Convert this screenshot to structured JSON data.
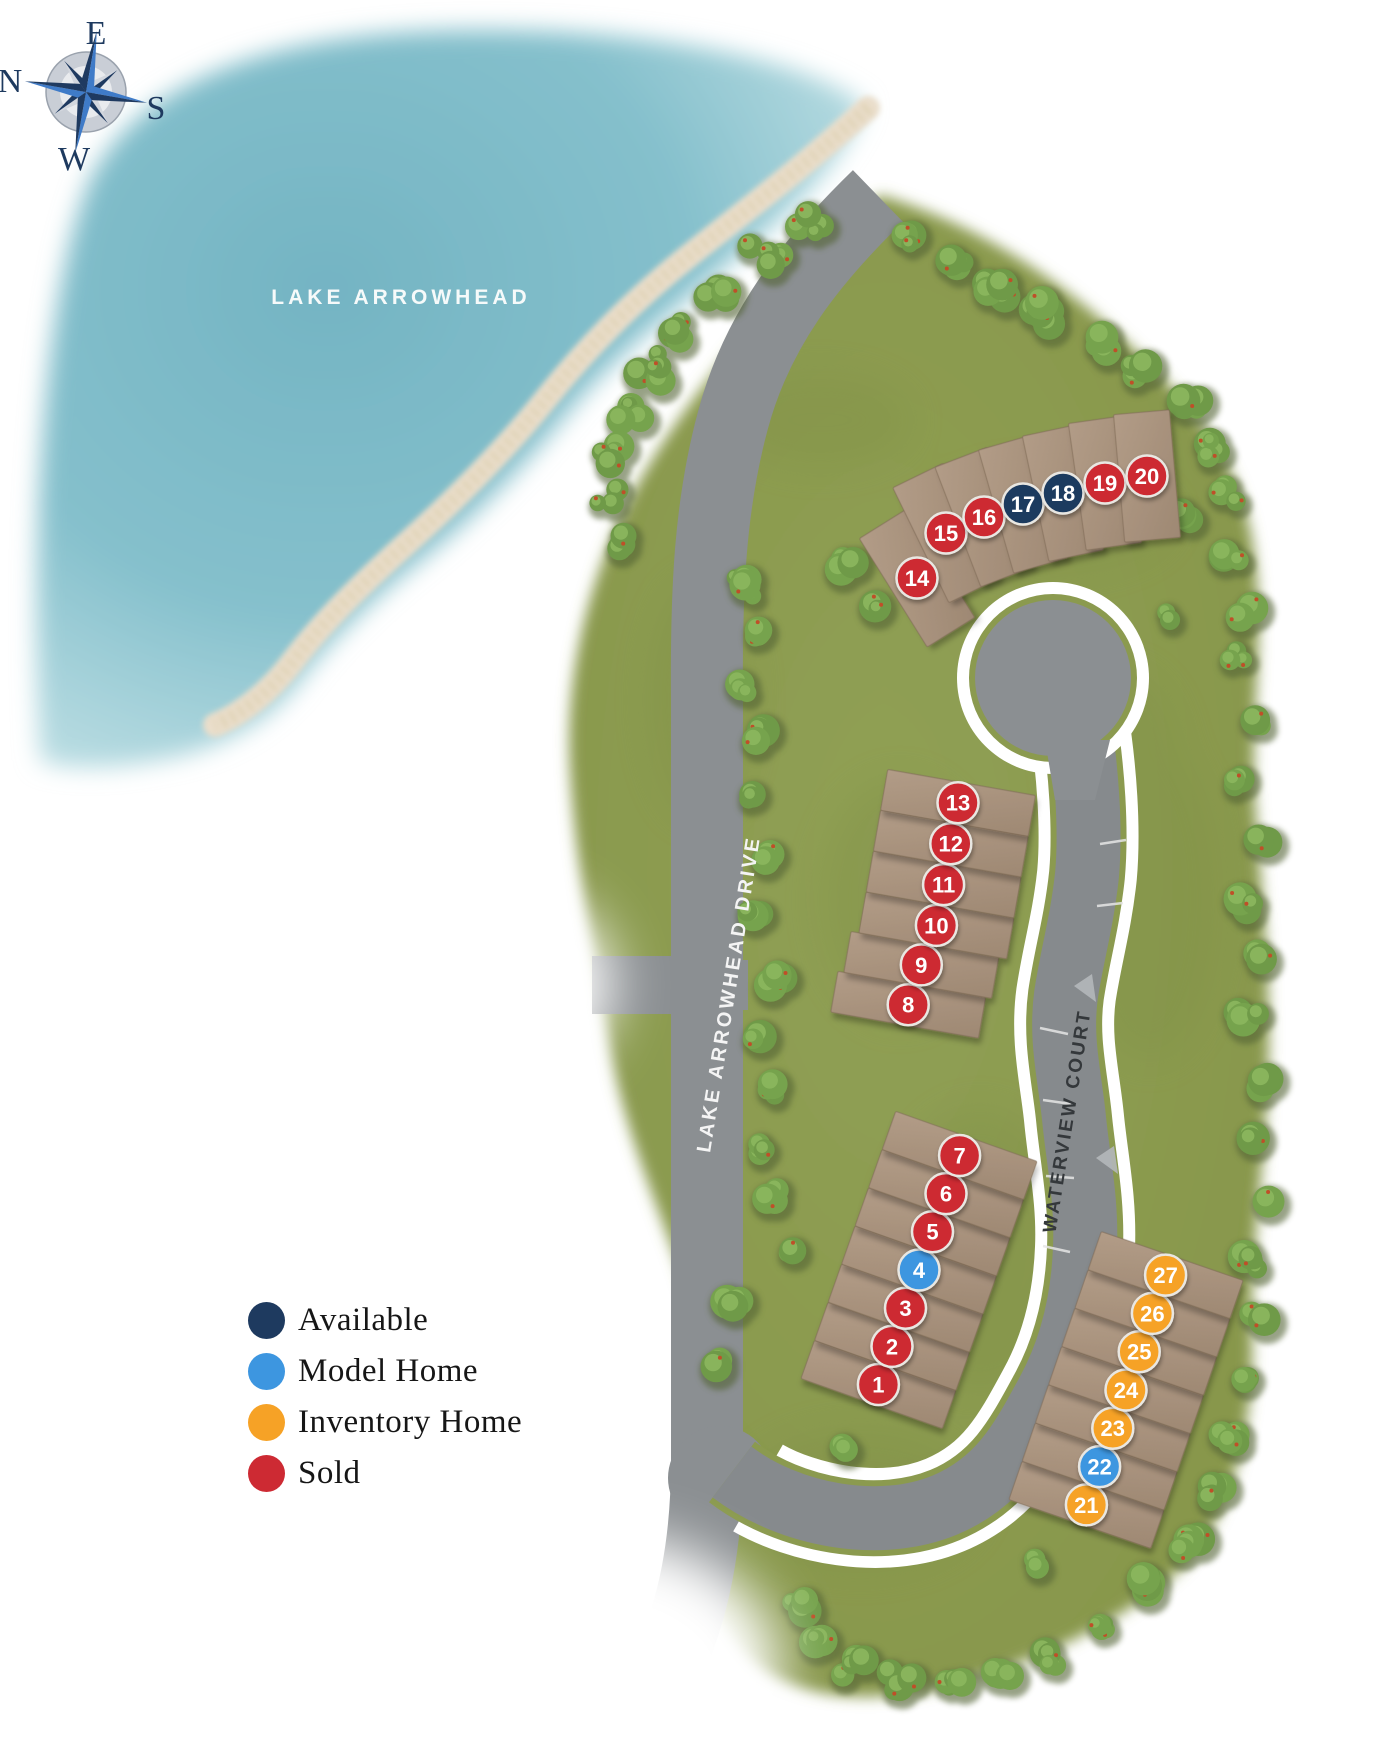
{
  "map": {
    "water_label": "LAKE ARROWHEAD",
    "roads": [
      {
        "id": "lake-arrowhead-drive",
        "label": "LAKE ARROWHEAD DRIVE"
      },
      {
        "id": "waterview-court",
        "label": "WATERVIEW COURT"
      }
    ]
  },
  "compass": {
    "top": "E",
    "right": "S",
    "bottom": "W",
    "left": "N"
  },
  "legend": {
    "items": [
      {
        "key": "available",
        "label": "Available",
        "color": "#1e3a5f"
      },
      {
        "key": "model",
        "label": "Model Home",
        "color": "#3d96e0"
      },
      {
        "key": "inventory",
        "label": "Inventory Home",
        "color": "#f6a226"
      },
      {
        "key": "sold",
        "label": "Sold",
        "color": "#cd2a33"
      }
    ]
  },
  "palette": {
    "grass": "#8b9a4f",
    "tree": "#6f9a48",
    "road": "#8b8f92",
    "sidewalk": "#ffffff",
    "lot_pad": "#a8927e",
    "water": "#7ab8c6",
    "sand": "#e8dcc2",
    "water_label_color": "#f6fafa",
    "road_label_dark": "#34383b",
    "marker_ring": "#e9e7e2"
  },
  "lots": [
    {
      "number": 1,
      "status": "sold"
    },
    {
      "number": 2,
      "status": "sold"
    },
    {
      "number": 3,
      "status": "sold"
    },
    {
      "number": 4,
      "status": "model"
    },
    {
      "number": 5,
      "status": "sold"
    },
    {
      "number": 6,
      "status": "sold"
    },
    {
      "number": 7,
      "status": "sold"
    },
    {
      "number": 8,
      "status": "sold"
    },
    {
      "number": 9,
      "status": "sold"
    },
    {
      "number": 10,
      "status": "sold"
    },
    {
      "number": 11,
      "status": "sold"
    },
    {
      "number": 12,
      "status": "sold"
    },
    {
      "number": 13,
      "status": "sold"
    },
    {
      "number": 14,
      "status": "sold"
    },
    {
      "number": 15,
      "status": "sold"
    },
    {
      "number": 16,
      "status": "sold"
    },
    {
      "number": 17,
      "status": "available"
    },
    {
      "number": 18,
      "status": "available"
    },
    {
      "number": 19,
      "status": "sold"
    },
    {
      "number": 20,
      "status": "sold"
    },
    {
      "number": 21,
      "status": "inventory"
    },
    {
      "number": 22,
      "status": "model"
    },
    {
      "number": 23,
      "status": "inventory"
    },
    {
      "number": 24,
      "status": "inventory"
    },
    {
      "number": 25,
      "status": "inventory"
    },
    {
      "number": 26,
      "status": "inventory"
    },
    {
      "number": 27,
      "status": "inventory"
    }
  ]
}
